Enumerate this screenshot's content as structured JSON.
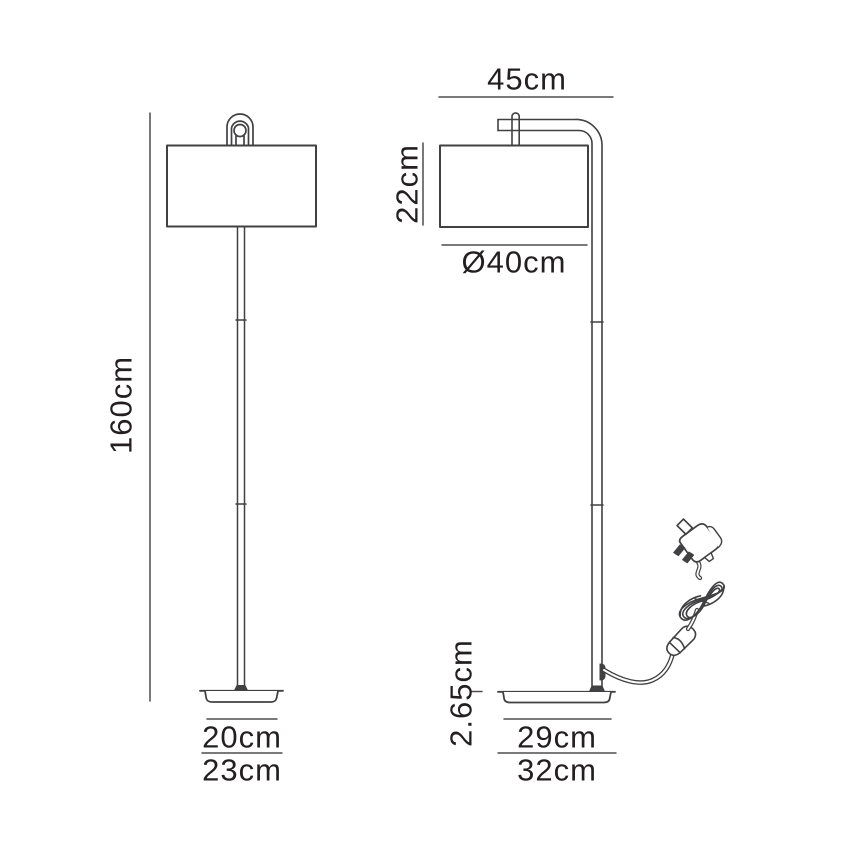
{
  "page": {
    "background": "#ffffff",
    "line_color": "#414042",
    "dim_line_color": "#4d4d4f",
    "text_color": "#231f20"
  },
  "diagram": {
    "subject": "floor lamp dimension drawing",
    "front_view": {
      "height_label": "160cm",
      "base_top_width_label": "20cm",
      "base_width_label": "23cm"
    },
    "side_view": {
      "depth_label": "45cm",
      "shade_height_label": "22cm",
      "shade_diameter_label": "Ø40cm",
      "base_height_label": "2.65cm",
      "base_top_depth_label": "29cm",
      "base_depth_label": "32cm"
    }
  }
}
